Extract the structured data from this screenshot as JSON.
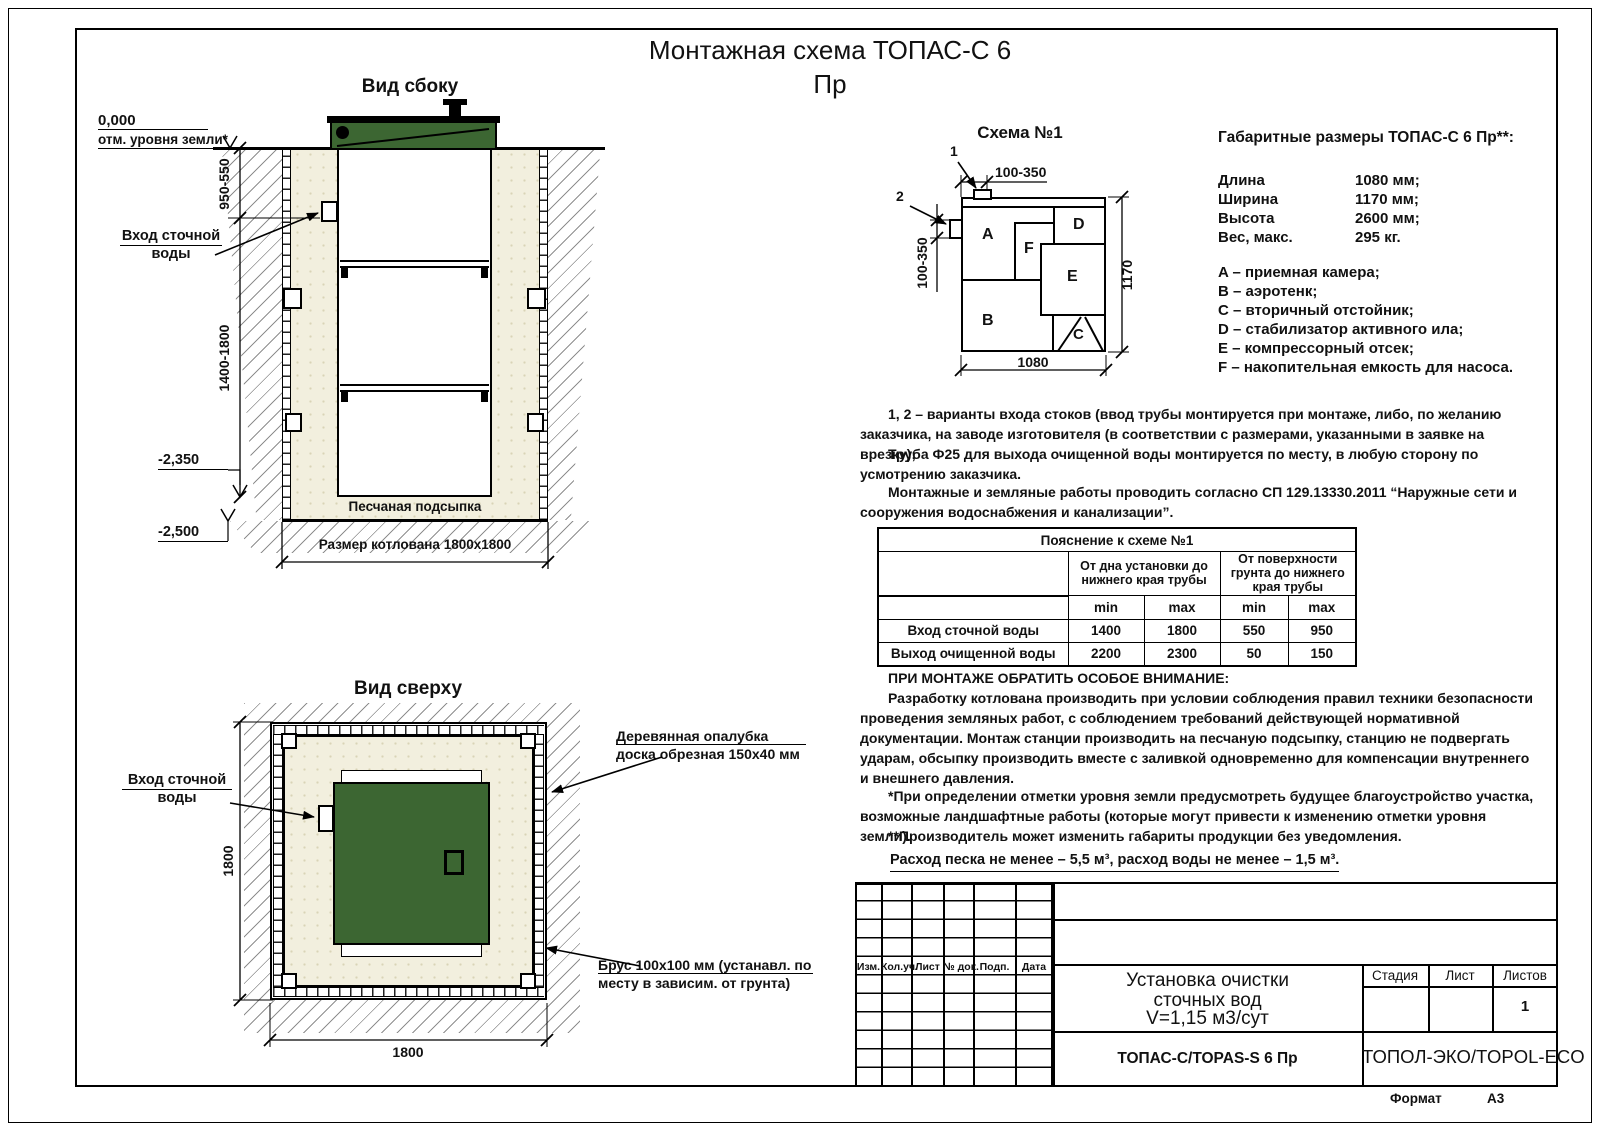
{
  "page": {
    "title_line1": "Монтажная схема ТОПАС-С 6",
    "title_line2": "Пр",
    "format_label": "Формат",
    "format_value": "А3"
  },
  "side_view": {
    "title": "Вид сбоку",
    "elev_zero": "0,000",
    "ground_label": "отм. уровня земли*",
    "dim_top": "950-550",
    "dim_main": "1400-1800",
    "elev_tank_bottom": "-2,350",
    "elev_pit_bottom": "-2,500",
    "inlet_label_1": "Вход сточной",
    "inlet_label_2": "воды",
    "sand_label": "Песчаная подсыпка",
    "pit_label": "Размер котлована 1800х1800"
  },
  "top_view": {
    "title": "Вид сверху",
    "inlet_label_1": "Вход сточной",
    "inlet_label_2": "воды",
    "formwork_label_1": "Деревянная опалубка",
    "formwork_label_2": "доска обрезная 150х40 мм",
    "beam_label_1": "Брус 100х100 мм (устанавл. по",
    "beam_label_2": "месту в зависим. от грунта)",
    "dim_vertical": "1800",
    "dim_horizontal": "1800"
  },
  "schema": {
    "title": "Схема №1",
    "marker_1": "1",
    "marker_2": "2",
    "dim_top": "100-350",
    "dim_left": "100-350",
    "dim_width": "1080",
    "dim_height": "1170",
    "comp_a": "A",
    "comp_b": "B",
    "comp_c": "C",
    "comp_d": "D",
    "comp_e": "E",
    "comp_f": "F"
  },
  "specs": {
    "title": "Габаритные размеры ТОПАС-С 6 Пр**:",
    "rows": [
      {
        "label": "Длина",
        "value": "1080 мм;"
      },
      {
        "label": "Ширина",
        "value": "1170 мм;"
      },
      {
        "label": "Высота",
        "value": "2600 мм;"
      },
      {
        "label": "Вес, макс.",
        "value": "295 кг."
      }
    ],
    "legend": [
      "A – приемная камера;",
      "B – аэротенк;",
      "C – вторичный отстойник;",
      "D – стабилизатор активного ила;",
      "E – компрессорный отсек;",
      "F – накопительная емкость для насоса."
    ]
  },
  "notes": {
    "p1a": "1, 2 – варианты входа  стоков (ввод трубы монтируется при монтаже, либо, по желанию заказчика, на заводе изготовителя (в соответствии с размерами, указанными в заявке на врезку);",
    "p1b": "Труба Ф25 для выхода очищенной воды монтируется по месту, в любую сторону по усмотрению заказчика.",
    "p2": "Монтажные и земляные работы проводить согласно СП 129.13330.2011 “Наружные сети и сооружения водоснабжения и канализации”.",
    "warning_title": "ПРИ МОНТАЖЕ ОБРАТИТЬ ОСОБОЕ ВНИМАНИЕ:",
    "warning_body": "Разработку котлована производить при условии соблюдения правил техники безопасности проведения земляных работ, с соблюдением требований действующей нормативной документации. Монтаж станции производить на песчаную подсыпку, станцию не подвергать ударам, обсыпку производить вместе с заливкой одновременно для компенсации внутреннего и внешнего давления.",
    "footnote_1": "*При определении отметки уровня земли предусмотреть будущее благоустройство участка, возможные ландшафтные работы (которые могут привести к изменению отметки уровня земли).",
    "footnote_2": "**Производитель может изменить габариты продукции без уведомления.",
    "consumption": "Расход песка не менее – 5,5 м³, расход воды не менее – 1,5 м³."
  },
  "table": {
    "title": "Пояснение к схеме №1",
    "group_1": "От дна установки до нижнего края трубы",
    "group_2": "От поверхности грунта до нижнего края трубы",
    "sub_min_1": "min",
    "sub_max_1": "max",
    "sub_min_2": "min",
    "sub_max_2": "max",
    "rows": [
      {
        "name": "Вход сточной воды",
        "v1": "1400",
        "v2": "1800",
        "v3": "550",
        "v4": "950"
      },
      {
        "name": "Выход очищенной воды",
        "v1": "2200",
        "v2": "2300",
        "v3": "50",
        "v4": "150"
      }
    ]
  },
  "title_block": {
    "col_izm": "Изм.",
    "col_kol": "Кол.уч.",
    "col_list": "Лист",
    "col_doc": "№ док.",
    "col_podp": "Подп.",
    "col_data": "Дата",
    "doc_line1": "Установка очистки",
    "doc_line2": "сточных вод",
    "doc_line3": "V=1,15 м3/сут",
    "col_stage": "Стадия",
    "col_sheet": "Лист",
    "col_sheets": "Листов",
    "sheets_value": "1",
    "product": "ТОПАС-С/TOPAS-S 6 Пр",
    "company": "ТОПОЛ-ЭКО/TOPOL-ECO"
  },
  "colors": {
    "lid_green": "#3c6632",
    "sand_beige": "#f2efde"
  }
}
